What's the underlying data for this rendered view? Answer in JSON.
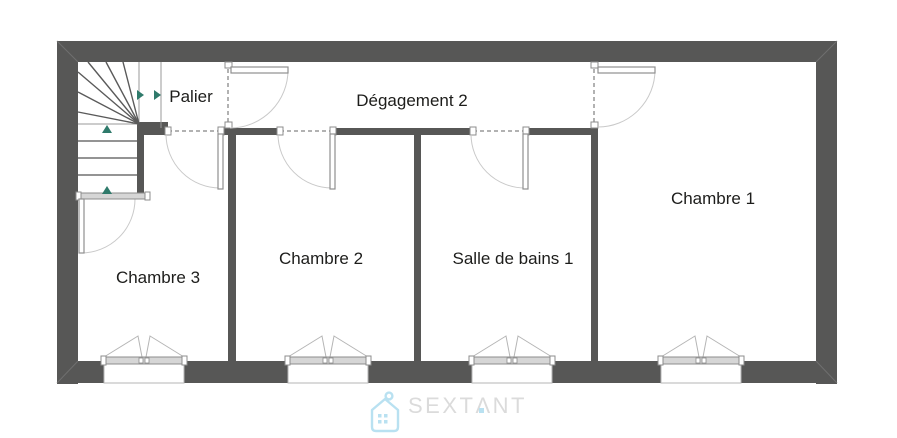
{
  "plan": {
    "rooms": [
      {
        "name": "Palier"
      },
      {
        "name": "Dégagement 2"
      },
      {
        "name": "Chambre 1"
      },
      {
        "name": "Chambre 2"
      },
      {
        "name": "Chambre 3"
      },
      {
        "name": "Salle de bains 1"
      }
    ],
    "colors": {
      "wall": "#575756",
      "door_arc": "#c9c9c9",
      "door_leaf_stroke": "#8f8f8f",
      "dashed_opening": "#999999",
      "stair_line": "#5a5a5a",
      "stair_arrow": "#2f7a6b",
      "window_frame": "#d6d6d6",
      "label_text": "#1d1d1b"
    }
  },
  "brand": {
    "name": "SEXTANT",
    "display": "SEXTΛNT",
    "icon": "house-tag-icon",
    "icon_color": "#b9e1f1",
    "text_color": "#dbdbdb"
  }
}
